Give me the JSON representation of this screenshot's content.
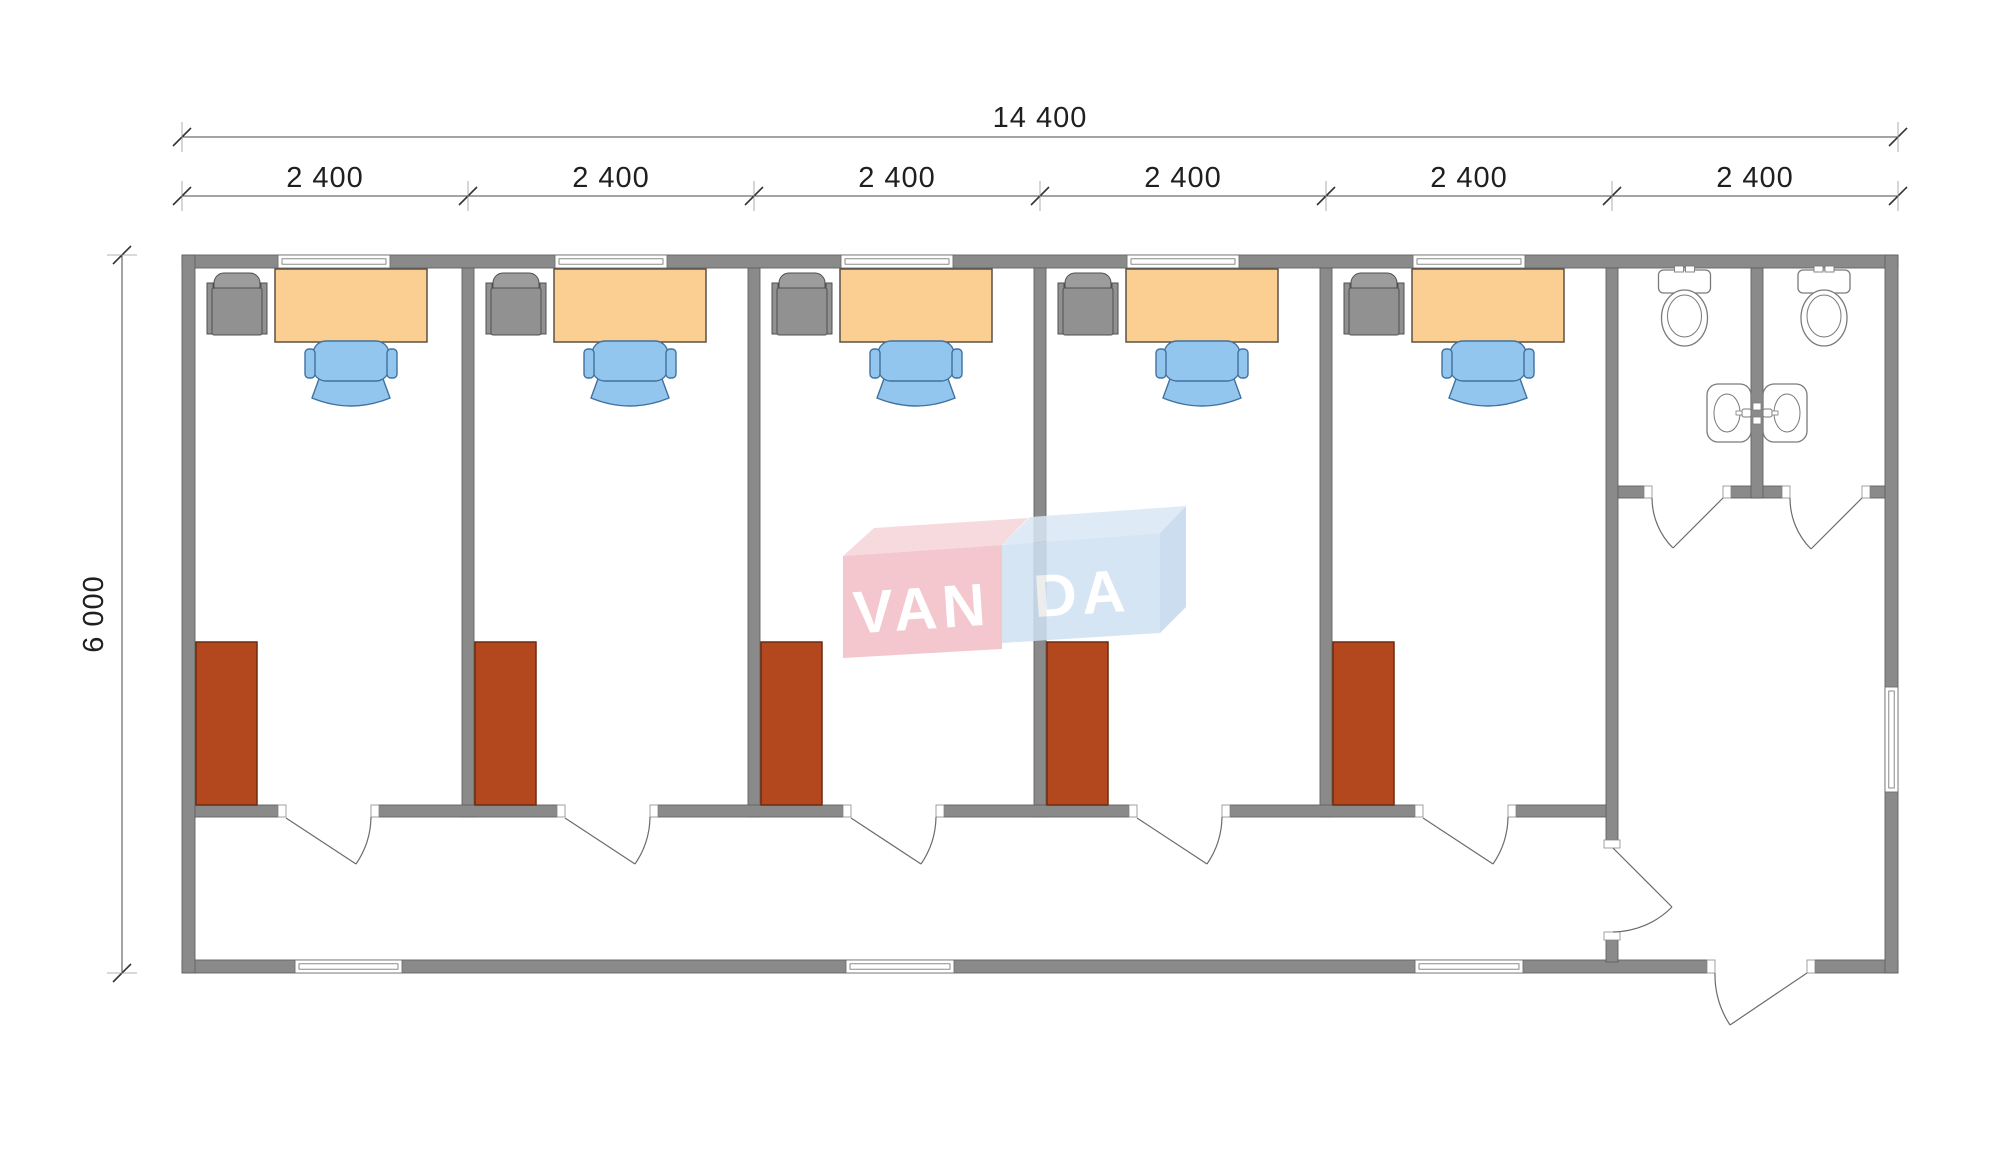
{
  "drawing": {
    "title": "modular office building floor plan",
    "dimensions": {
      "total_width_label": "14 400",
      "bay_labels": [
        "2 400",
        "2 400",
        "2 400",
        "2 400",
        "2 400",
        "2 400"
      ],
      "height_label": "6 000"
    },
    "watermark": {
      "brand": "VANDA",
      "parts": [
        "VAN",
        "DA"
      ]
    },
    "rooms": {
      "offices_count": 5,
      "office_furniture": [
        "cabinet",
        "desk",
        "office-chair",
        "wardrobe"
      ],
      "toilet_stalls_count": 2,
      "sanitary_fixtures": [
        "toilet",
        "toilet",
        "sink",
        "sink"
      ]
    },
    "colors": {
      "wall": "#8a8a8a",
      "wall_stroke": "#616161",
      "desk": "#fbce92",
      "desk_stroke": "#5a5245",
      "chair": "#93c6ef",
      "chair_stroke": "#41719c",
      "wardrobe": "#b3471d",
      "wardrobe_stroke": "#6e2a0e",
      "cabinet": "#919191",
      "cabinet_stroke": "#4f4f4f",
      "fixture_stroke": "#7a7a7a",
      "door_stroke": "#6b6b6b",
      "dim_stroke": "#4a4a4a",
      "logo_pink_front": "#f2bec5",
      "logo_pink_top": "#f6d4d9",
      "logo_blue_front": "#cfe1f2",
      "logo_blue_top": "#d9e7f5",
      "logo_blue_side": "#c3d8ec"
    }
  }
}
